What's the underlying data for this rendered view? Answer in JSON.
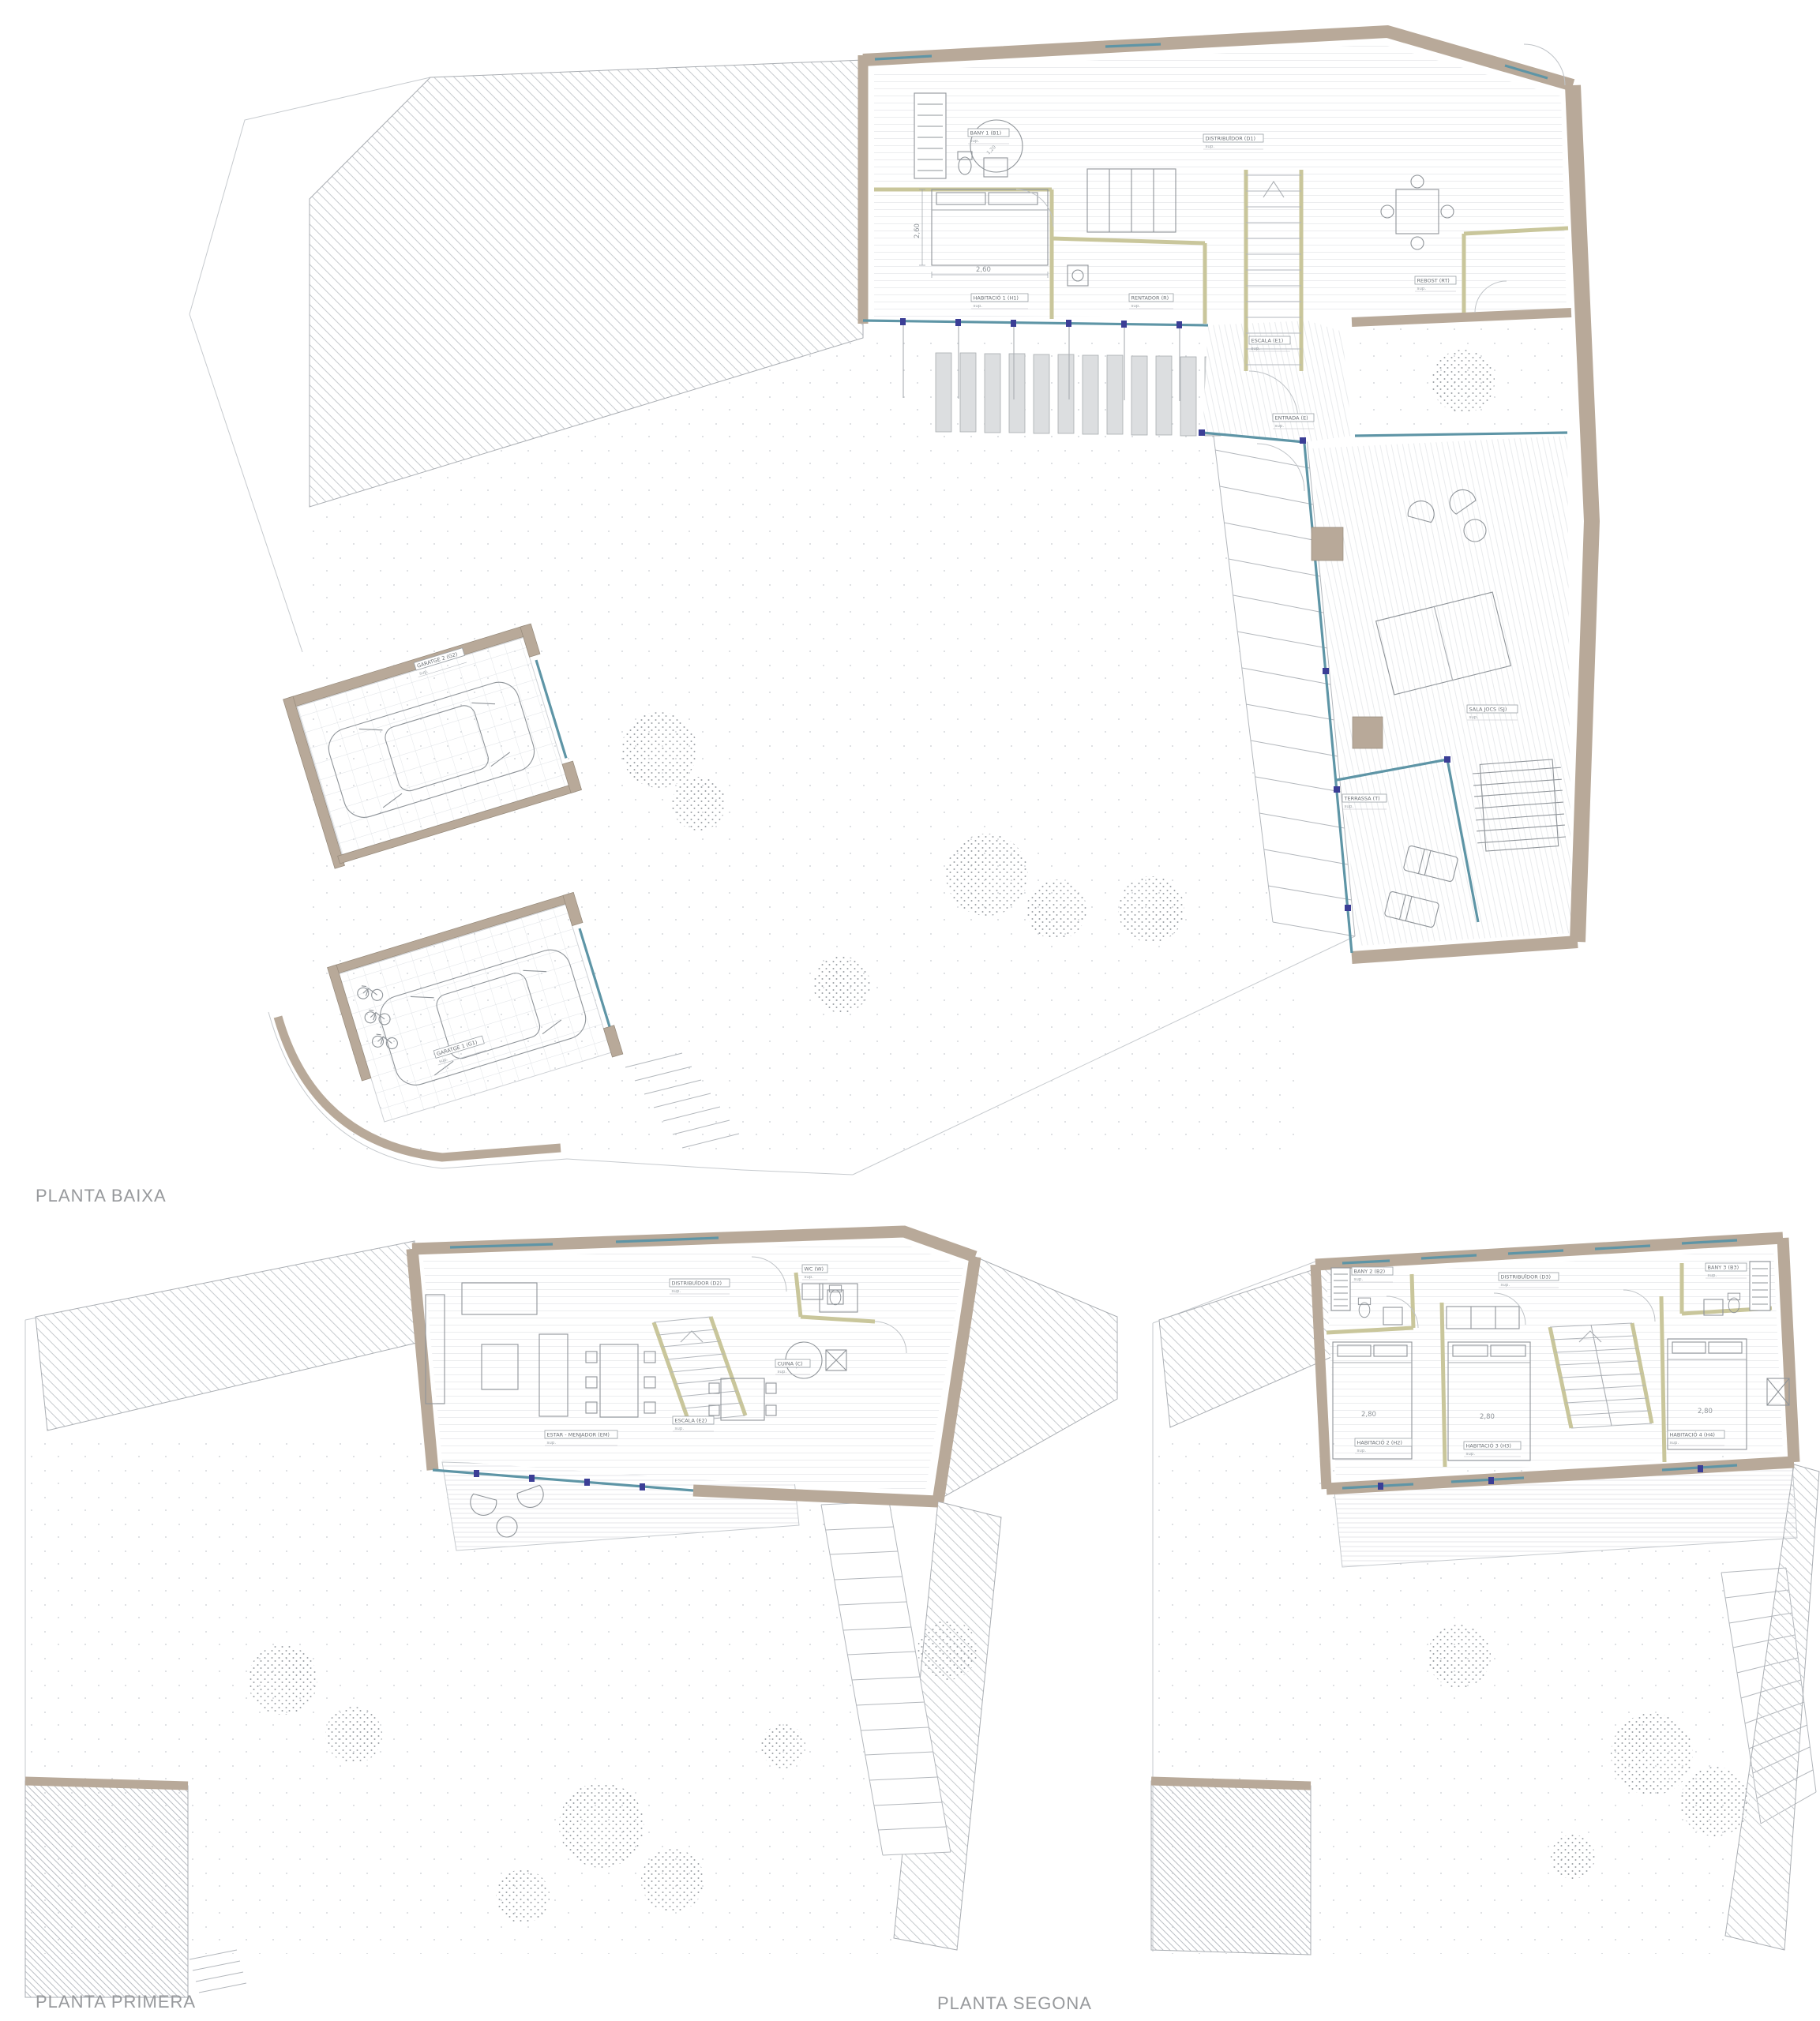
{
  "document": {
    "type": "architectural-floor-plans",
    "sheet_background": "#ffffff"
  },
  "palette": {
    "wall": "#b8a999",
    "interior_partition": "#c9c69b",
    "glazing": "#5e95a6",
    "mullion": "#3b3e96",
    "hatch_line": "#c3c7cc",
    "label_text": "#6a6f74",
    "title_text": "#97999c",
    "floor_line": "#ecedef",
    "furniture_line": "#8f9499"
  },
  "plans": {
    "baixa": {
      "title": "PLANTA BAIXA",
      "rooms": [
        {
          "label": "BANY 1 (B1)",
          "sub": "sup."
        },
        {
          "label": "HABITACIÓ 1 (H1)",
          "sub": "sup."
        },
        {
          "label": "DISTRIBUÏDOR (D1)",
          "sub": "sup."
        },
        {
          "label": "RENTADOR (R)",
          "sub": "sup."
        },
        {
          "label": "ESCALA (E1)",
          "sub": "sup."
        },
        {
          "label": "REBOST (RT)",
          "sub": "sup."
        },
        {
          "label": "ENTRADA (E)",
          "sub": "sup."
        },
        {
          "label": "SALA JOCS (SJ)",
          "sub": "sup."
        },
        {
          "label": "TERRASSA (T)",
          "sub": "sup."
        },
        {
          "label": "GARATGE 2 (G2)",
          "sub": "sup."
        },
        {
          "label": "GARATGE 1 (G1)",
          "sub": "sup."
        }
      ],
      "dimensions": {
        "bed_width": "2,60",
        "bed_length": "2,60",
        "shower_diameter": "1,20"
      }
    },
    "primera": {
      "title": "PLANTA PRIMERA",
      "rooms": [
        {
          "label": "ESTAR - MENJADOR (EM)",
          "sub": "sup."
        },
        {
          "label": "DISTRIBUÏDOR (D2)",
          "sub": "sup."
        },
        {
          "label": "CUINA (C)",
          "sub": "sup."
        },
        {
          "label": "ESCALA (E2)",
          "sub": "sup."
        },
        {
          "label": "WC (W)",
          "sub": "sup."
        }
      ],
      "dimensions": {
        "table_diameter": "1,20"
      }
    },
    "segona": {
      "title": "PLANTA SEGONA",
      "rooms": [
        {
          "label": "DISTRIBUÏDOR (D3)",
          "sub": "sup."
        },
        {
          "label": "BANY 2 (B2)",
          "sub": "sup."
        },
        {
          "label": "BANY 3 (B3)",
          "sub": "sup."
        },
        {
          "label": "HABITACIÓ 2 (H2)",
          "sub": "sup."
        },
        {
          "label": "HABITACIÓ 3 (H3)",
          "sub": "sup."
        },
        {
          "label": "HABITACIÓ 4 (H4)",
          "sub": "sup."
        }
      ],
      "dimensions": {
        "bed2": "2,80",
        "bed3": "2,80",
        "bed4": "2,80"
      }
    }
  }
}
